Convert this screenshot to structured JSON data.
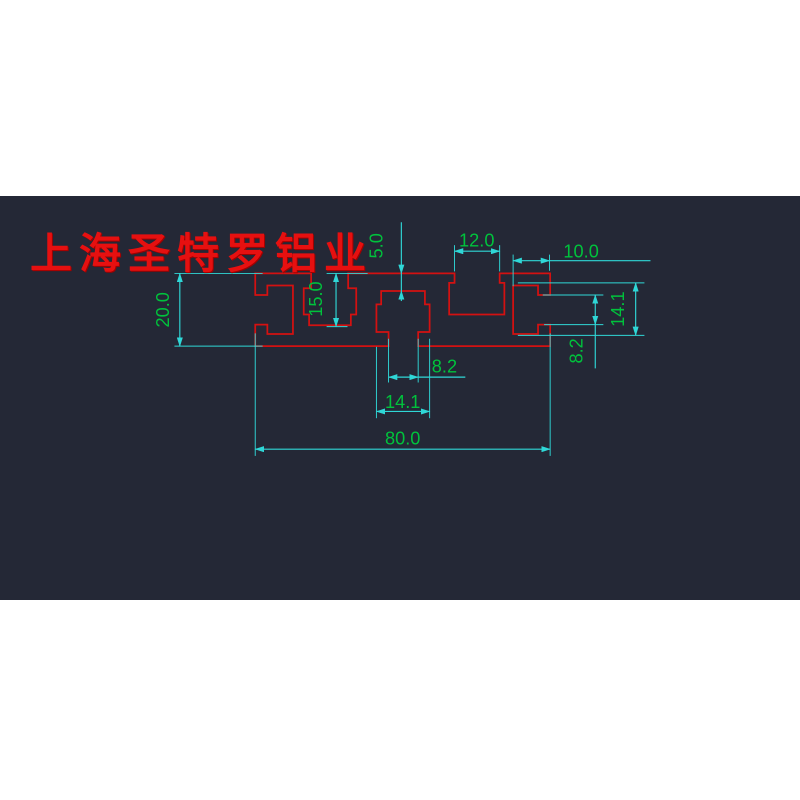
{
  "watermark": "上海圣特罗铝业",
  "dims": {
    "profile_height": "20.0",
    "slot_depth": "15.0",
    "top_wall": "5.0",
    "top_slot_width": "12.0",
    "right_slot_depth": "10.0",
    "right_cavity_height": "14.1",
    "right_mouth_height": "8.2",
    "bottom_mouth_width": "8.2",
    "bottom_cavity_width": "14.1",
    "profile_width": "80.0"
  },
  "colors": {
    "canvas": "#242836",
    "page": "#ffffff",
    "profile_outline": "#d41111",
    "dimension_lines": "#2fd7d7",
    "dimension_text": "#00c23c",
    "watermark_text": "#e61010"
  }
}
